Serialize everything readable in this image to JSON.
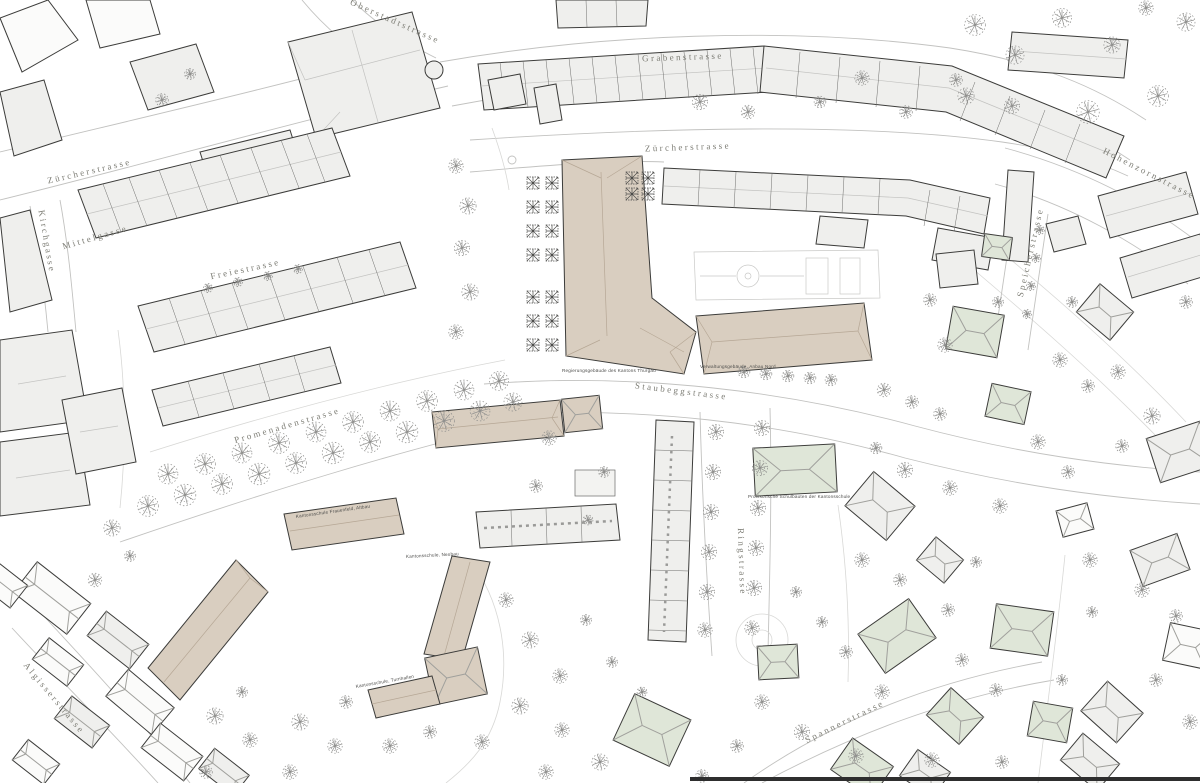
{
  "map": {
    "kind": "architectural-site-plan",
    "streets": {
      "oberstadtstrasse": "Oberstadtstrasse",
      "grabenstrasse": "Grabenstrasse",
      "zuercherstrasse": "Zürcherstrasse",
      "zuercherstrasse_west": "Zürcherstrasse",
      "mittelgasse": "Mittelgasse",
      "kirchgasse": "Kirchgasse",
      "freiestrasse": "Freiestrasse",
      "promenadenstrasse": "Promenadenstrasse",
      "staubeggstrasse": "Staubeggstrasse",
      "ringstrasse": "Ringstrasse",
      "hohenzornstrasse": "Hohenzornstrasse",
      "speicherstrasse": "Speicherstrasse",
      "spannerstrasse": "Spannerstrasse",
      "algisserstrasse": "Algisserstrasse"
    },
    "captions": {
      "regierungsgebaeude": "Regierungsgebäude des Kantons Thurgau",
      "verwaltungsgebaeude": "Verwaltungsgebäude, Anbau Nord",
      "provisorium": "Provisorische Schulbauten der Kantonsschule",
      "kantonsschule_altbau": "Kantonsschule Frauenfeld, Altbau",
      "kantonsschule_neubau": "Kantonsschule, Neubau",
      "kantonsschule_turnhallen": "Kantonsschule, Turnhallen"
    },
    "colors": {
      "background": "#ffffff",
      "building_gray": "#efefed",
      "building_beige": "#d9cec0",
      "building_green": "#dfe6d8",
      "outline": "#3c3c3a",
      "street_edge": "#c2c2c0",
      "tree": "#8e8e8c",
      "label": "#7d7d75"
    }
  }
}
